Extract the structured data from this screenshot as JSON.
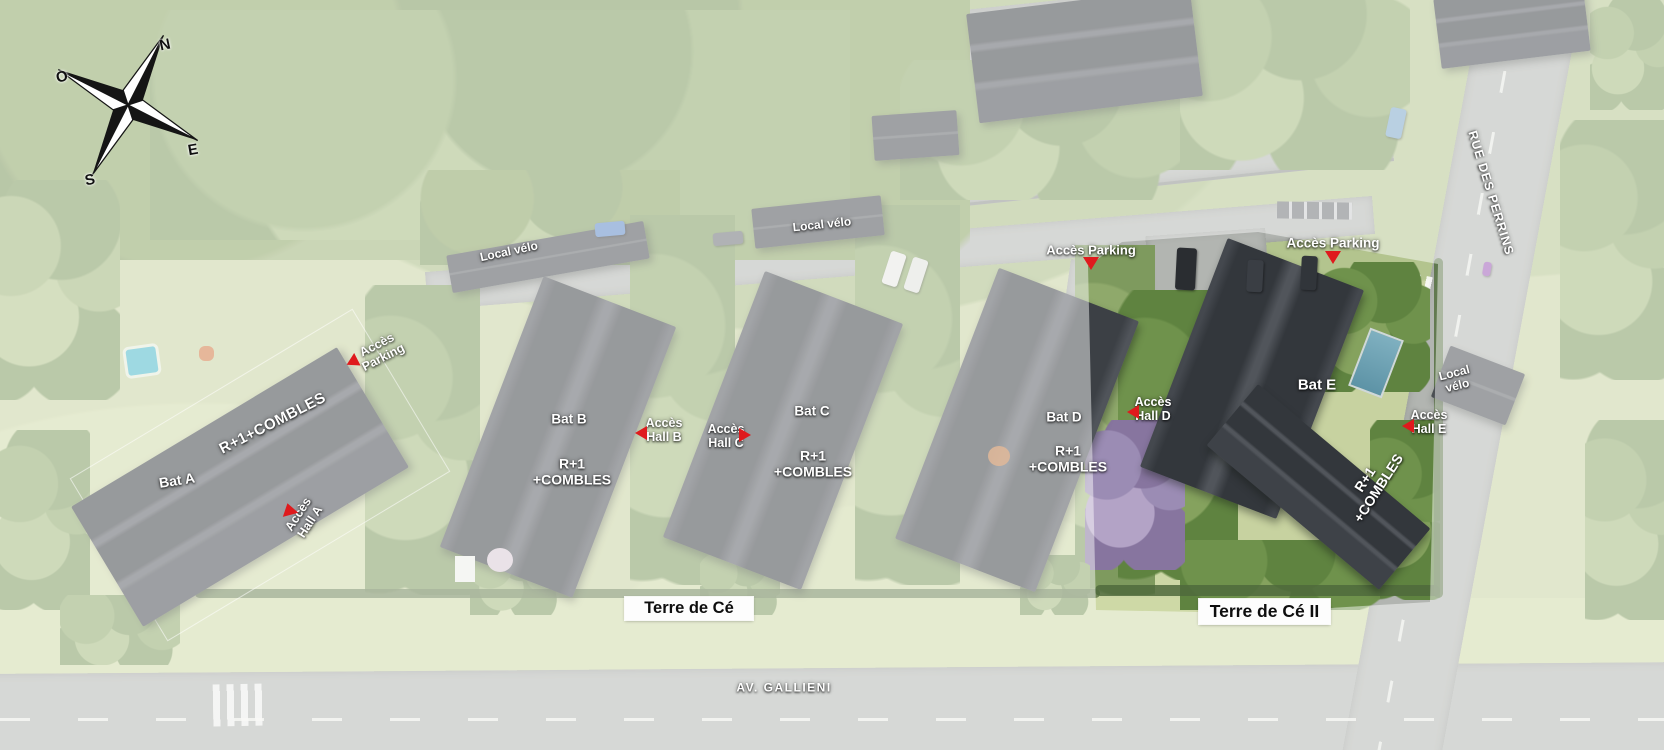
{
  "compass": {
    "north": "N",
    "west": "O",
    "east": "E",
    "south": "S"
  },
  "roads": {
    "av_gallieni": "AV. GALLIENI",
    "rue_des_perrins": "RUE DES PERRINS"
  },
  "banners": {
    "phase1": "Terre de Cé",
    "phase2": "Terre de Cé II"
  },
  "facilities": {
    "local_velo_west": "Local vélo",
    "local_velo_center": "Local vélo",
    "local_velo_east": "Local\nvélo"
  },
  "access": {
    "parking_bat_a": "Accès\nParking",
    "parking_center": "Accès Parking",
    "parking_east": "Accès Parking",
    "hall_a": "Accès\nHall A",
    "hall_b": "Accès\nHall B",
    "hall_c": "Accès\nHall C",
    "hall_d": "Accès\nHall D",
    "hall_e": "Accès\nHall E"
  },
  "buildings": {
    "bat_a": {
      "name": "Bat A",
      "levels": "R+1+COMBLES"
    },
    "bat_b": {
      "name": "Bat B",
      "levels": "R+1\n+COMBLES"
    },
    "bat_c": {
      "name": "Bat C",
      "levels": "R+1\n+COMBLES"
    },
    "bat_d": {
      "name": "Bat D",
      "levels": "R+1\n+COMBLES"
    },
    "bat_e": {
      "name": "Bat E",
      "levels": "R+1\n+COMBLES"
    }
  },
  "colors": {
    "marker_red": "#df1a1d",
    "highlight_wash": "#ffffff",
    "roof_grey": "#3c4045",
    "lawn_green": "#c7d2a0"
  }
}
